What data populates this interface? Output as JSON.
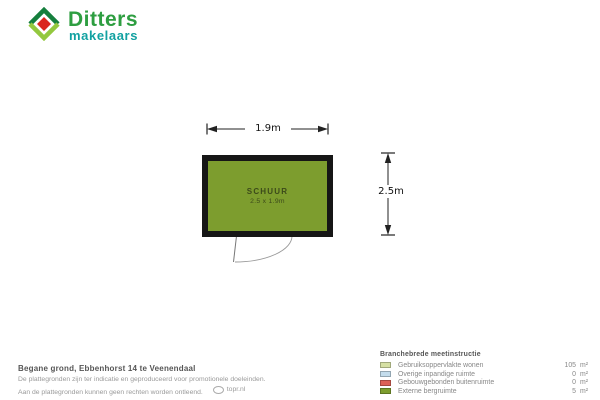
{
  "logo": {
    "name": "Ditters",
    "subtitle": "makelaars",
    "brand_green": "#2e9e41",
    "brand_teal": "#12a1a1",
    "mark_dark_green": "#157f3d",
    "mark_lime": "#93c83e",
    "mark_red": "#da251d"
  },
  "plan": {
    "room_label": "SCHUUR",
    "room_size": "2.5 x 1.9m",
    "width_label": "1.9m",
    "height_label": "2.5m",
    "room_color": "#7d9d2e",
    "wall_color": "#161616"
  },
  "footer": {
    "title": "Begane grond, Ebbenhorst 14 te Veenendaal",
    "disclaimer_line1": "De plattegronden zijn ter indicatie en geproduceerd voor promotionele doeleinden.",
    "disclaimer_line2": "Aan de plattegronden kunnen geen rechten worden ontleend.",
    "credit": "topr.nl"
  },
  "legend": {
    "header": "Branchebrede meetinstructie",
    "items": [
      {
        "label": "Gebruiksoppervlakte wonen",
        "value": "105",
        "unit": "m²",
        "color": "#d6e0a4"
      },
      {
        "label": "Overige inpandige ruimte",
        "value": "0",
        "unit": "m²",
        "color": "#c3dcec"
      },
      {
        "label": "Gebouwgebonden buitenruimte",
        "value": "0",
        "unit": "m²",
        "color": "#dd6157"
      },
      {
        "label": "Externe bergruimte",
        "value": "5",
        "unit": "m²",
        "color": "#7d9d2e"
      }
    ]
  }
}
